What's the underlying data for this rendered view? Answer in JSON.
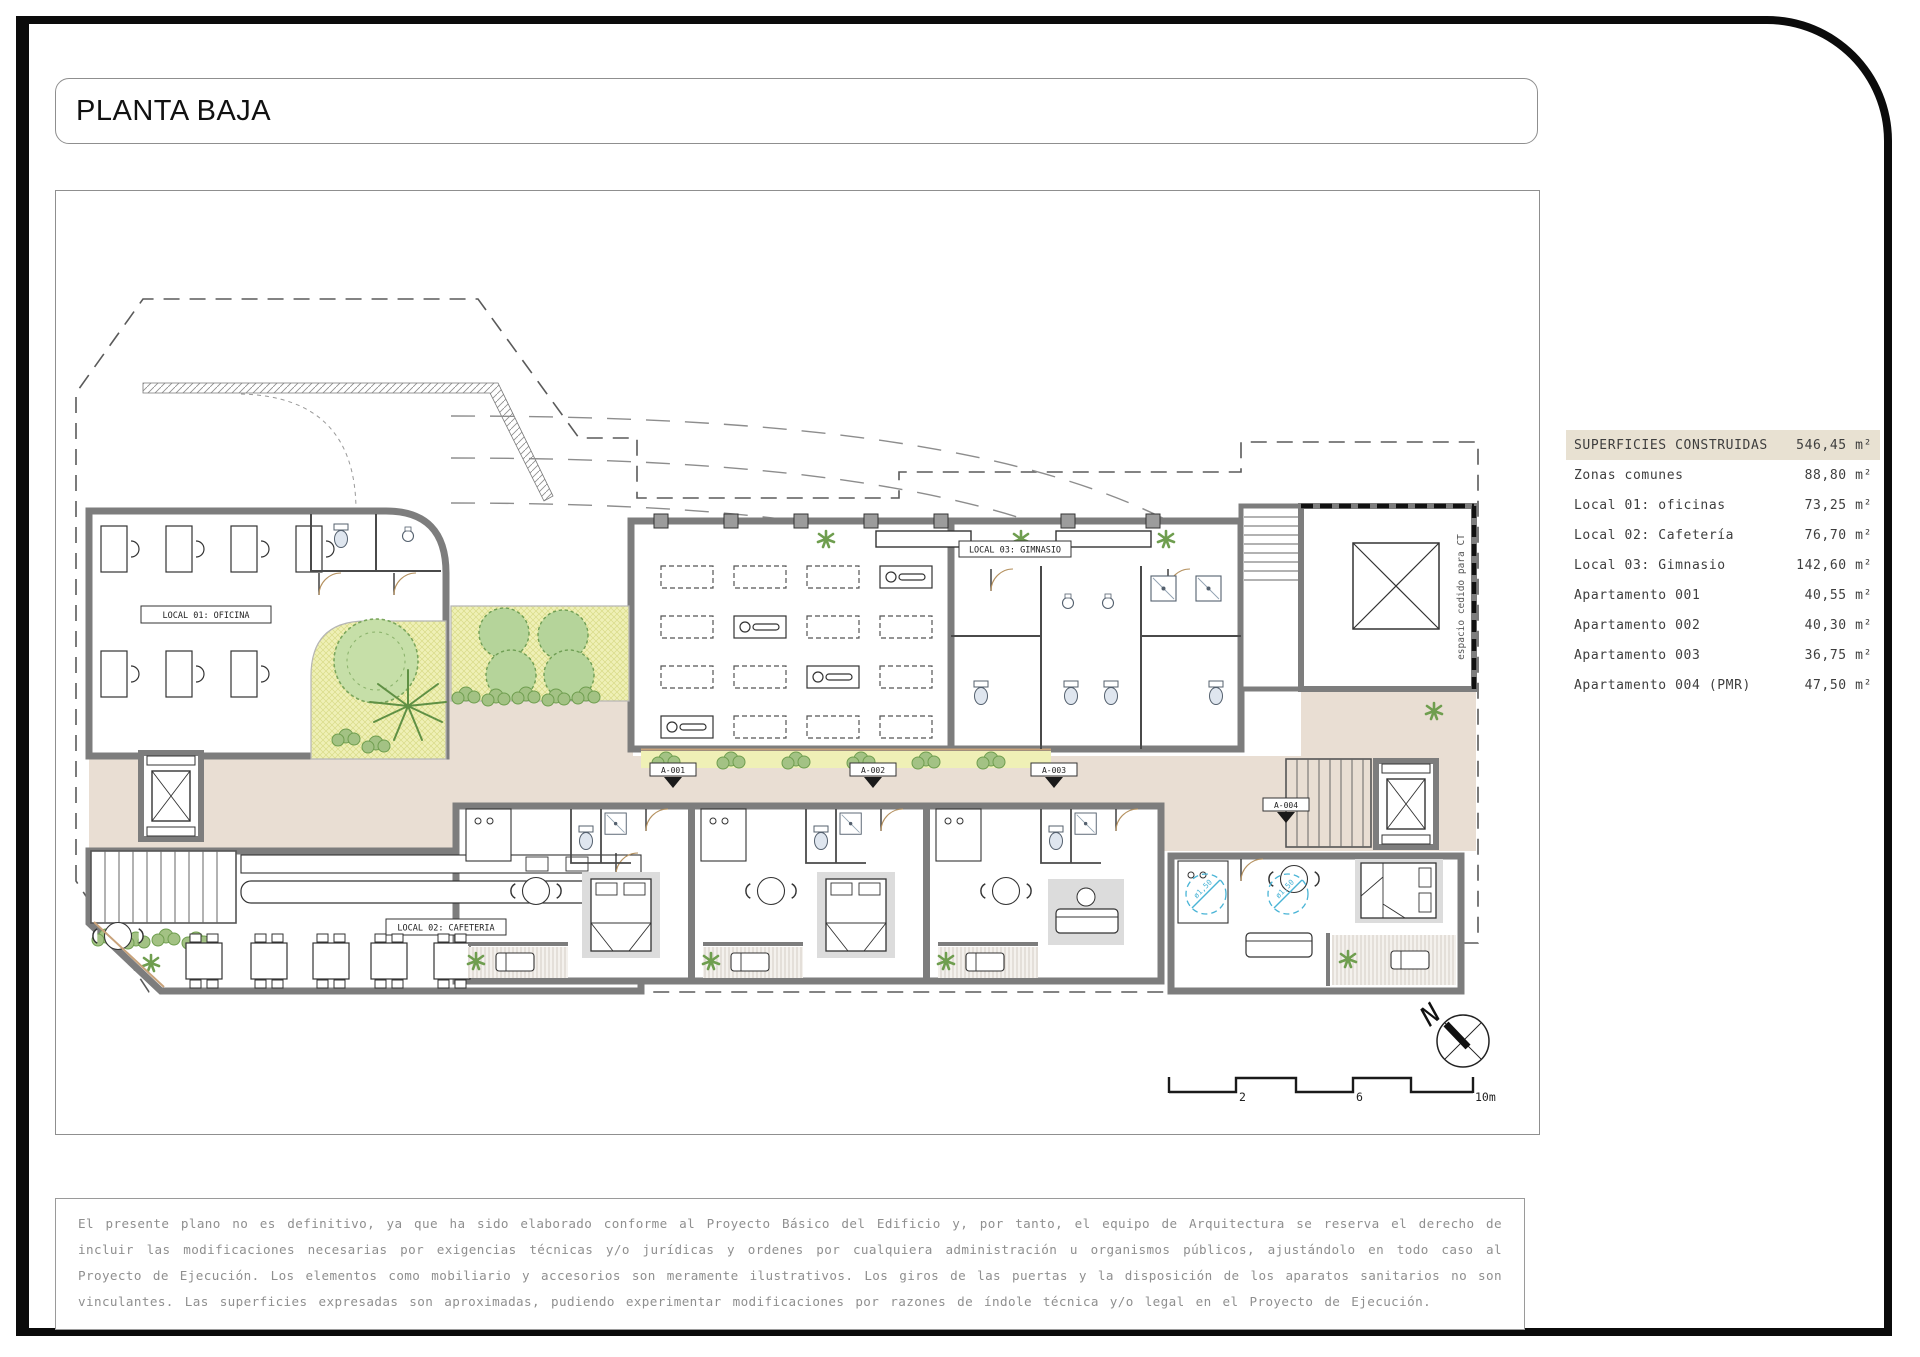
{
  "page": {
    "title": "PLANTA BAJA"
  },
  "plan": {
    "room_labels": {
      "local01": "LOCAL 01:  OFICINA",
      "local02": "LOCAL 02:  CAFETERIA",
      "local03": "LOCAL 03: GIMNASIO"
    },
    "unit_labels": [
      "A-001",
      "A-002",
      "A-003",
      "A-004"
    ],
    "ct_note": "espacio cedido para CT",
    "accessibility_radius": "ø1,50",
    "north_label": "N",
    "scale_labels": [
      "2",
      "6",
      "10m"
    ]
  },
  "areas_table": {
    "header": {
      "label": "SUPERFICIES CONSTRUIDAS",
      "value": "546,45 m²"
    },
    "rows": [
      {
        "label": "Zonas comunes",
        "value": "88,80 m²"
      },
      {
        "label": "Local 01:  oficinas",
        "value": "73,25 m²"
      },
      {
        "label": "Local 02:  Cafetería",
        "value": "76,70 m²"
      },
      {
        "label": "Local 03:  Gimnasio",
        "value": "142,60 m²"
      },
      {
        "label": "Apartamento 001",
        "value": "40,55 m²"
      },
      {
        "label": "Apartamento 002",
        "value": "40,30 m²"
      },
      {
        "label": "Apartamento 003",
        "value": "36,75 m²"
      },
      {
        "label": "Apartamento 004 (PMR)",
        "value": "47,50 m²"
      }
    ]
  },
  "colors": {
    "wall": "#7d7d7d",
    "floor_common": "#e9ded3",
    "garden": "#eff0b6",
    "accent_wood": "#c8a27a",
    "accessibility_blue": "#49b4d6",
    "table_header_bg": "#e8e1d2"
  },
  "disclaimer": "El presente plano no es definitivo, ya que ha sido elaborado conforme al Proyecto Básico del Edificio y, por tanto, el equipo de Arquitectura se reserva el derecho de incluir las modificaciones necesarias por exigencias técnicas y/o jurídicas y ordenes por cualquiera administración u organismos públicos, ajustándolo en todo caso al Proyecto de Ejecución. Los elementos como mobiliario y accesorios son meramente ilustrativos. Los giros de las puertas y la disposición de los aparatos sanitarios no son vinculantes. Las superficies expresadas son aproximadas, pudiendo experimentar modificaciones por razones de índole técnica y/o legal en el Proyecto de Ejecución."
}
